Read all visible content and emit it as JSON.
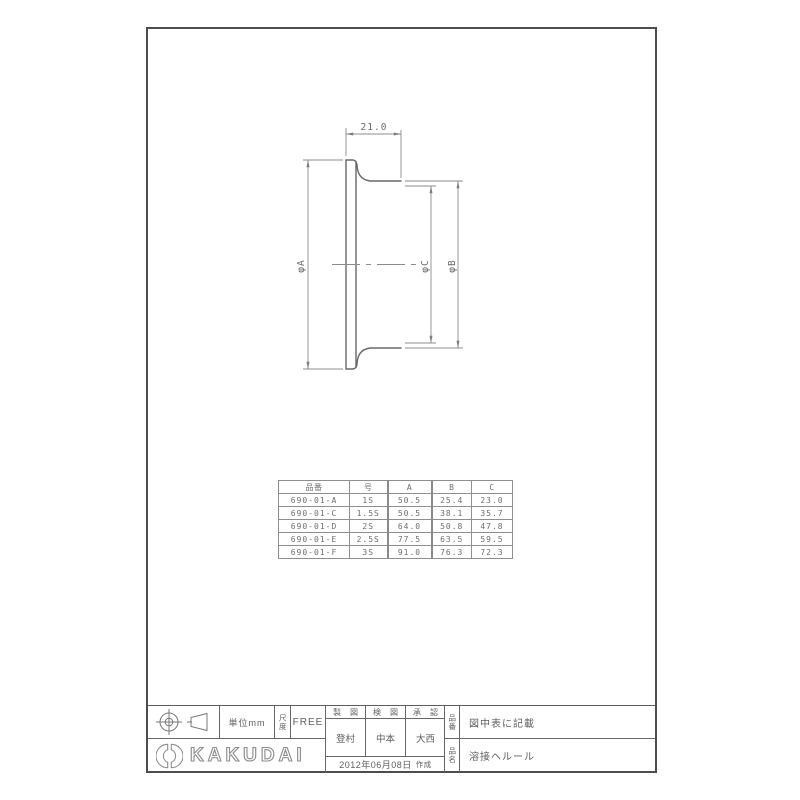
{
  "drawing": {
    "length_dim": "21.0",
    "dia_a_label": "φA",
    "dia_b_label": "φB",
    "dia_c_label": "φC"
  },
  "table": {
    "headers": [
      "品番",
      "号",
      "A",
      "B",
      "C"
    ],
    "rows": [
      [
        "690-01-A",
        "1S",
        "50.5",
        "25.4",
        "23.0"
      ],
      [
        "690-01-C",
        "1.5S",
        "50.5",
        "38.1",
        "35.7"
      ],
      [
        "690-01-D",
        "2S",
        "64.0",
        "50.8",
        "47.8"
      ],
      [
        "690-01-E",
        "2.5S",
        "77.5",
        "63.5",
        "59.5"
      ],
      [
        "690-01-F",
        "3S",
        "91.0",
        "76.3",
        "72.3"
      ]
    ]
  },
  "title_block": {
    "unit_label": "単位mm",
    "scale_label": "尺度",
    "scale_value": "FREE",
    "drafting_label": "製図",
    "checking_label": "検図",
    "approval_label": "承認",
    "drafting_name": "登村",
    "checking_name": "中本",
    "approval_name": "大西",
    "date": "2012年06月08日",
    "date_suffix": "作成",
    "part_no_label": "品番",
    "part_no_value": "図中表に記載",
    "part_name_label": "品名",
    "part_name_value": "溶接ヘルール",
    "brand": "KAKUDAI"
  },
  "colors": {
    "object_line": "#686868",
    "dim_line": "#8c8c8c",
    "frame": "#4d4d4d"
  }
}
